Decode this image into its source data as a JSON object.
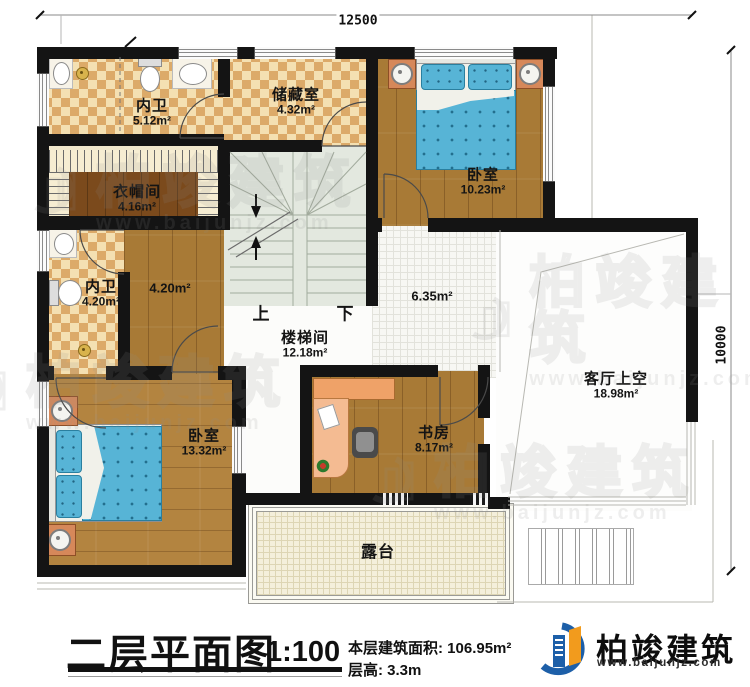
{
  "dimensions": {
    "top": "12500",
    "right": "10000"
  },
  "rooms": [
    {
      "name": "内卫",
      "area": "5.12m²"
    },
    {
      "name": "储藏室",
      "area": "4.32m²"
    },
    {
      "name": "卧室",
      "area": "10.23m²"
    },
    {
      "name": "衣帽间",
      "area": "4.16m²"
    },
    {
      "name": "内卫",
      "area": "4.20m²"
    },
    {
      "name": "",
      "area": "4.20m²"
    },
    {
      "name": "楼梯间",
      "area": "12.18m²"
    },
    {
      "name": "",
      "area": "6.35m²"
    },
    {
      "name": "客厅上空",
      "area": "18.98m²"
    },
    {
      "name": "卧室",
      "area": "13.32m²"
    },
    {
      "name": "书房",
      "area": "8.17m²"
    },
    {
      "name": "露台",
      "area": ""
    }
  ],
  "stairs": {
    "up": "上",
    "down": "下"
  },
  "titleblock": {
    "title": "二层平面图",
    "scale": "1:100",
    "area_label": "本层建筑面积:",
    "area_value": "106.95m²",
    "floor_height_label": "层高:",
    "floor_height_value": "3.3m"
  },
  "logo": {
    "company": "柏竣建筑",
    "website": "www.baijunjz.com"
  },
  "watermark": {
    "company": "柏竣建筑",
    "website": "www.baijunjz.com"
  },
  "colors": {
    "wall": "#141414",
    "checker_tile": "#dcaa69",
    "wood_floor": "#a87a36",
    "bed_blue": "#57b4d6",
    "stair": "#e3e8df",
    "terrace": "#f4efdb",
    "logo_blue": "#1d5fa8",
    "logo_orange": "#f29b1d"
  }
}
